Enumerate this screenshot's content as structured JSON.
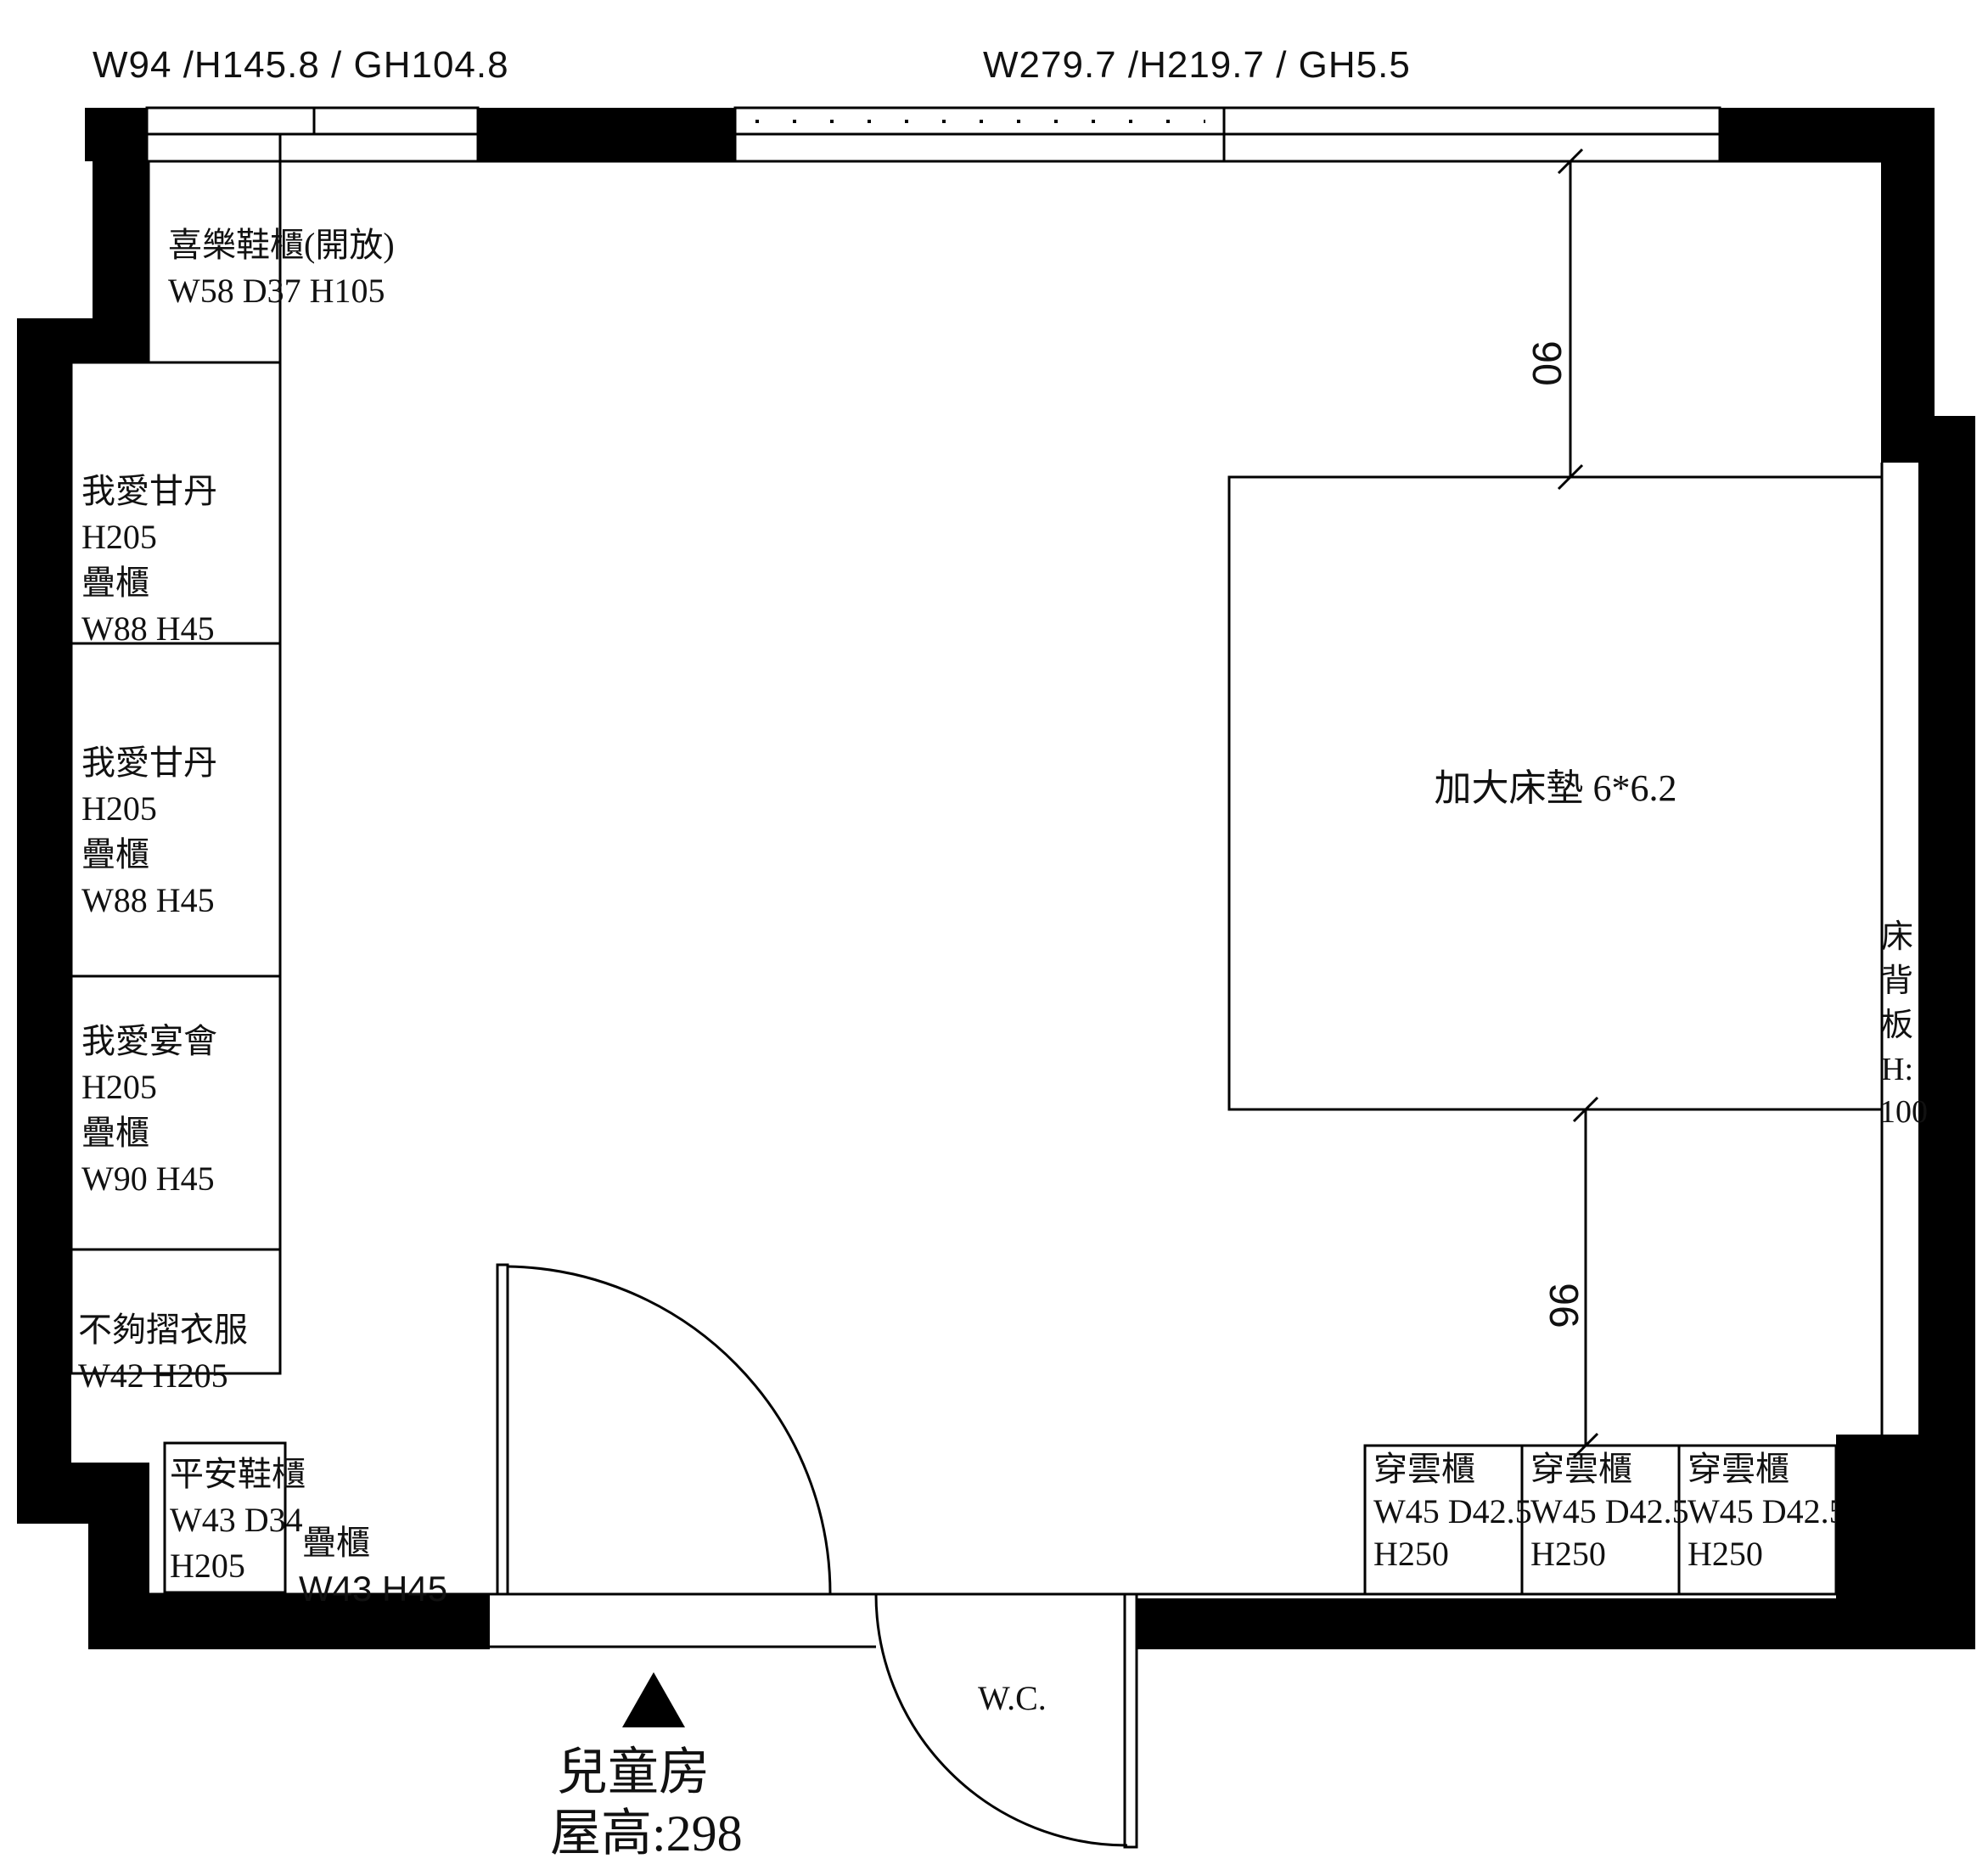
{
  "window_labels": {
    "left": "W94 /H145.8 / GH104.8",
    "top": "W279.7 /H219.7 / GH5.5"
  },
  "left_cabinets": {
    "shoe_open": {
      "line1": "喜樂鞋櫃(開放)",
      "line2": "W58 D37 H105"
    },
    "stack1": {
      "line1": "我愛甘丹",
      "line2": "H205",
      "line3": "疊櫃",
      "line4": "W88 H45"
    },
    "stack2": {
      "line1": "我愛甘丹",
      "line2": "H205",
      "line3": "疊櫃",
      "line4": "W88 H45"
    },
    "stack3": {
      "line1": "我愛宴會",
      "line2": "H205",
      "line3": "疊櫃",
      "line4": "W90 H45"
    },
    "fold": {
      "line1": "不夠摺衣服",
      "line2": "W42 H205"
    },
    "shoe_safe": {
      "line1": "平安鞋櫃",
      "line2": "W43 D34",
      "line3": "H205"
    },
    "stack_note": {
      "line1": "疊櫃",
      "line2": "W43 H45"
    }
  },
  "bed": {
    "label": "加大床墊 6*6.2"
  },
  "headboard": {
    "chars": [
      "床",
      "背",
      "板",
      "H:",
      "100"
    ]
  },
  "dims": {
    "window_side": "90",
    "cabinet_side": "96"
  },
  "wardrobes": [
    {
      "line1": "穿雲櫃",
      "line2": "W45 D42.5",
      "line3": "H250"
    },
    {
      "line1": "穿雲櫃",
      "line2": "W45 D42.5",
      "line3": "H250"
    },
    {
      "line1": "穿雲櫃",
      "line2": "W45 D42.5",
      "line3": "H250"
    }
  ],
  "wc": {
    "label": "W.C."
  },
  "room": {
    "name": "兒童房",
    "ceiling": "屋高:298"
  }
}
